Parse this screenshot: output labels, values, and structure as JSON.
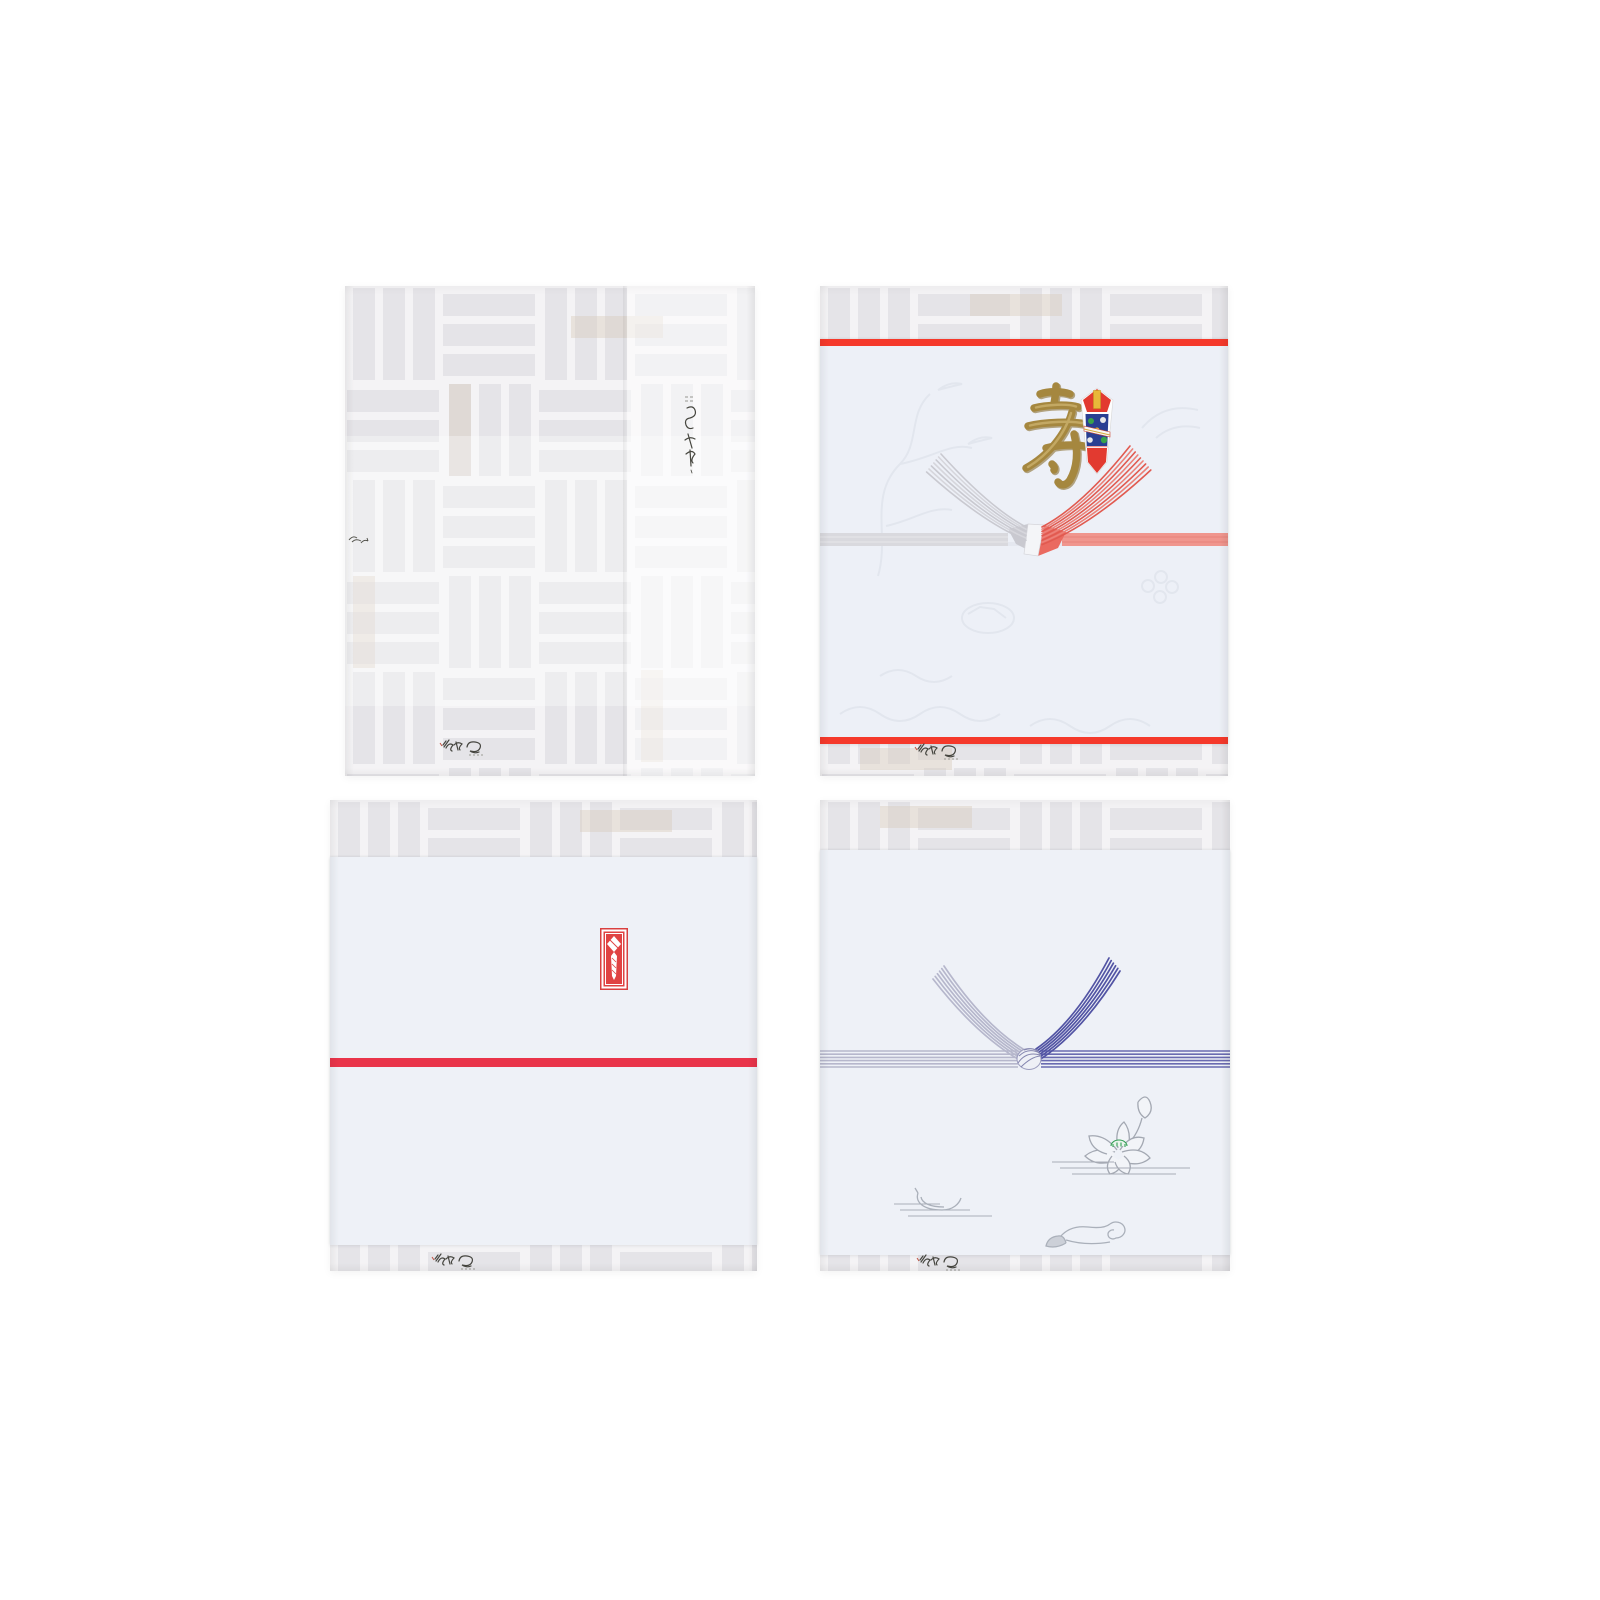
{
  "scene": {
    "type": "product-photo",
    "background": "#ffffff",
    "item_count": 4,
    "caption": ""
  },
  "packages": [
    {
      "label": "gift box wrapped in pale basket-weave patterned paper",
      "pattern": "basket-weave",
      "paper_color": "#f4f3f5",
      "bar_color": "#e5e4e8",
      "accent_color": "#d6cbb9",
      "marks": [
        "vertical-calligraphy-mark",
        "edge-calligraphy-mark",
        "maker-logo-mark"
      ]
    },
    {
      "label": "celebration noshi paper with gold kotobuki, red and silver mizuhiki and noshi ornament",
      "kanji": "寿",
      "kanji_color": "#a5873f",
      "border_line_color": "#f5392b",
      "paper_color": "#edf0f7",
      "mizuhiki_left_color": "#c9c9d0",
      "mizuhiki_right_color": "#e15a50",
      "band_left_color": "#d9d9de",
      "band_right_color": "#f0968e",
      "ornament_colors": {
        "red": "#e23a30",
        "blue": "#2a3f92",
        "gold": "#e8b83a",
        "green": "#3aa34a"
      },
      "emboss_color": "#e2e6ee",
      "marks": [
        "maker-logo-mark"
      ]
    },
    {
      "label": "white noshi paper with red noshi seal and single red stripe",
      "paper_color": "#eef1f7",
      "stripe_color": "#e9344a",
      "seal_color": "#e04343",
      "marks": [
        "noshi-seal",
        "maker-logo-mark"
      ]
    },
    {
      "label": "buddhist noshi paper with blue-purple mizuhiki knot, lotus, boat and cloud motifs",
      "paper_color": "#eef1f7",
      "mizuhiki_color": "#5254a4",
      "mizuhiki_light_color": "#b6b7cc",
      "knot_fill": "#eef0f6",
      "lotus_line_color": "#a3a8b2",
      "lotus_green": "#319e53",
      "motif_line_color": "#aab0ba",
      "marks": [
        "maker-logo-mark"
      ]
    }
  ]
}
